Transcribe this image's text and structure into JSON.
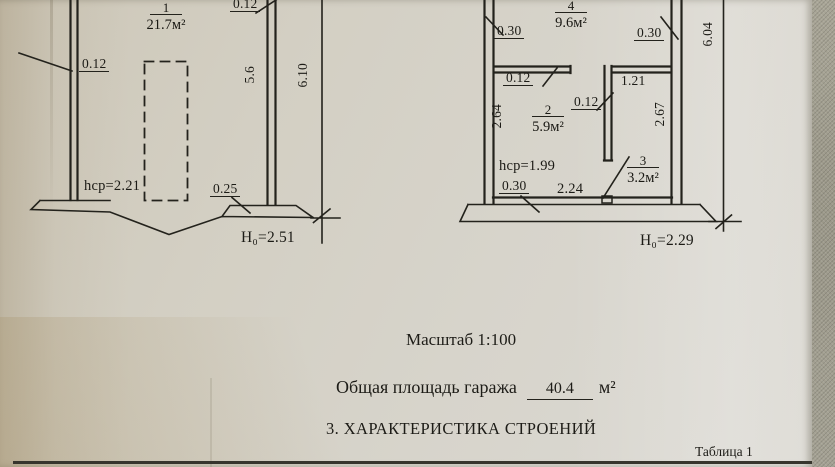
{
  "photo": {
    "paper_color": "#d5d1c7",
    "fabric_color": "#a3a093",
    "ink_color": "#23221c"
  },
  "plan_left": {
    "room1": {
      "number": "1",
      "area": "21.7м²"
    },
    "dims": {
      "wall_left": "0.12",
      "wall_right_top": "0.12",
      "inner_length": "5.6",
      "outer_length": "6.10",
      "avg_height": "hср=2.21",
      "footing_width": "0.25",
      "height_note": "Н₀=2.51"
    }
  },
  "plan_right": {
    "room4": {
      "number": "4",
      "area": "9.6м²"
    },
    "room2": {
      "number": "2",
      "area": "5.9м²"
    },
    "room3": {
      "number": "3",
      "area": "3.2м²"
    },
    "dims": {
      "wall_top_left": "0.30",
      "wall_top_right": "0.30",
      "partial_top": "2",
      "outer_length": "6.04",
      "partition_left": "0.12",
      "niche_width": "1.21",
      "partition_mid": "0.12",
      "room2_depth": "2.64",
      "room3_depth": "2.67",
      "avg_height": "hср=1.99",
      "wall_bottom_left": "0.30",
      "bottom_width": "2.24",
      "height_note": "Н₀=2.29"
    }
  },
  "notes": {
    "scale": "Масштаб 1:100",
    "total_area_label": "Общая площадь гаража",
    "total_area_value": "40.4",
    "total_area_unit": "м²",
    "section_heading": "3. ХАРАКТЕРИСТИКА СТРОЕНИЙ",
    "table_caption": "Таблица 1"
  }
}
